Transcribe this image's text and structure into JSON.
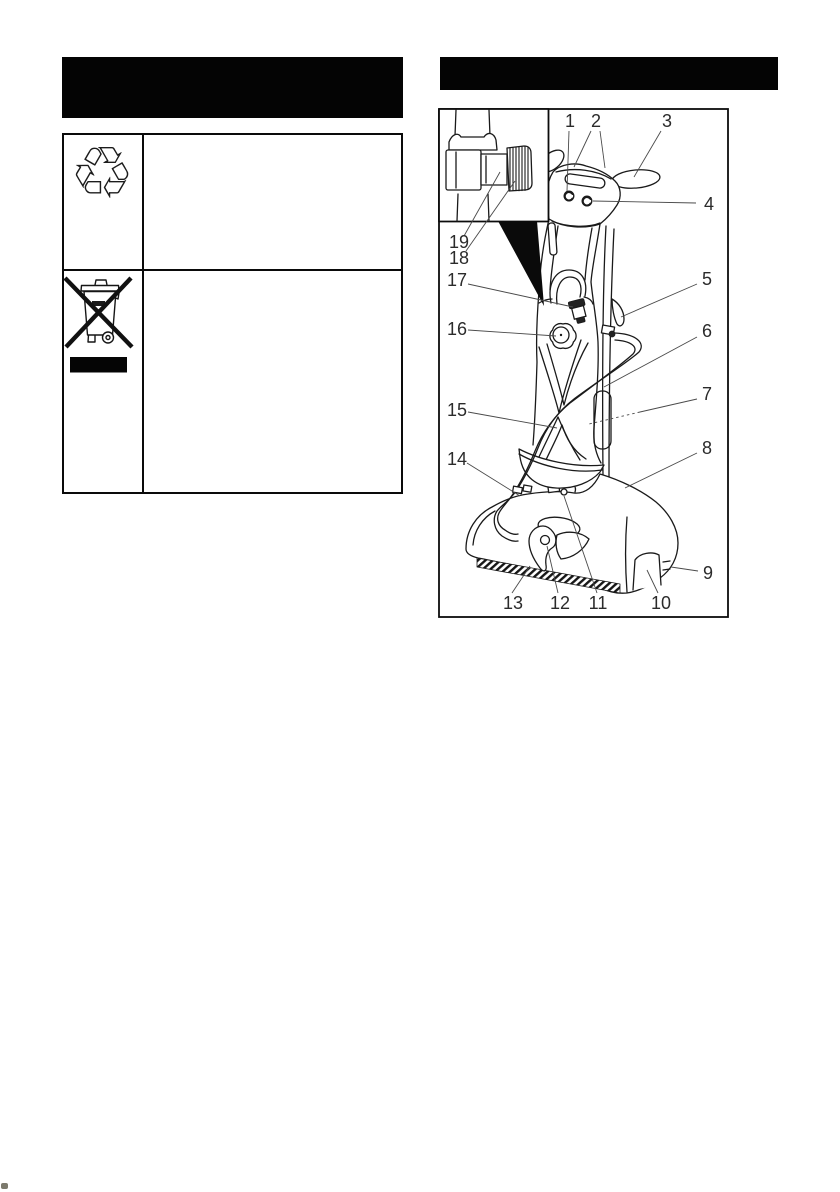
{
  "page": {
    "width": 840,
    "height": 1192,
    "background": "#ffffff",
    "ink": "#1a1a1a",
    "redaction_color": "#040404"
  },
  "left_column": {
    "title_bar": {
      "text": "",
      "style": "solid-black-redacted-two-line"
    },
    "symbol_table": {
      "rows": [
        {
          "icon": "universal-recycling-symbol",
          "glyph": "♲",
          "text": ""
        },
        {
          "icon": "weee-crossed-out-wheeled-bin",
          "glyph": "",
          "text": "",
          "underbar": "solid-black"
        }
      ]
    }
  },
  "right_column": {
    "title_bar": {
      "text": "",
      "style": "solid-black-redacted-one-line"
    },
    "figure": {
      "type": "numbered-parts-diagram",
      "subject": "upright floor scrubber line drawing with detail inset of hose coupling",
      "inset_callouts": [
        "19",
        "18"
      ],
      "callouts": [
        {
          "n": "1",
          "x": 570,
          "y": 121,
          "leaders": [
            [
              569,
              131,
              567,
              191
            ]
          ]
        },
        {
          "n": "2",
          "x": 596,
          "y": 121,
          "leaders": [
            [
              591,
              131,
              574,
              167
            ],
            [
              600,
              131,
              605,
              168
            ]
          ]
        },
        {
          "n": "3",
          "x": 667,
          "y": 121,
          "leaders": [
            [
              661,
              131,
              634,
              177
            ]
          ]
        },
        {
          "n": "4",
          "x": 709,
          "y": 204,
          "leaders": [
            [
              696,
              203,
              593,
              201
            ]
          ]
        },
        {
          "n": "5",
          "x": 707,
          "y": 279,
          "leaders": [
            [
              697,
              284,
              621,
              317
            ]
          ]
        },
        {
          "n": "6",
          "x": 707,
          "y": 331,
          "leaders": [
            [
              697,
              337,
              604,
              387
            ]
          ]
        },
        {
          "n": "7",
          "x": 707,
          "y": 394,
          "leaders": [
            [
              697,
              399,
              640,
              412
            ],
            [
              640,
              412,
              589,
              424,
              "dashed"
            ]
          ]
        },
        {
          "n": "8",
          "x": 707,
          "y": 448,
          "leaders": [
            [
              697,
              453,
              625,
              488
            ]
          ]
        },
        {
          "n": "9",
          "x": 708,
          "y": 573,
          "leaders": [
            [
              698,
              571,
              671,
              567
            ]
          ]
        },
        {
          "n": "10",
          "x": 661,
          "y": 603,
          "leaders": [
            [
              658,
              593,
              647,
              570
            ]
          ]
        },
        {
          "n": "11",
          "x": 598,
          "y": 603,
          "leaders": [
            [
              597,
              593,
              564,
              496
            ]
          ]
        },
        {
          "n": "12",
          "x": 560,
          "y": 603,
          "leaders": [
            [
              558,
              593,
              547,
              546
            ]
          ]
        },
        {
          "n": "13",
          "x": 513,
          "y": 603,
          "leaders": [
            [
              512,
              593,
              530,
              566
            ]
          ]
        },
        {
          "n": "14",
          "x": 457,
          "y": 459,
          "leaders": [
            [
              467,
              463,
              520,
              496
            ]
          ]
        },
        {
          "n": "15",
          "x": 457,
          "y": 410,
          "leaders": [
            [
              468,
              412,
              557,
              428
            ]
          ]
        },
        {
          "n": "16",
          "x": 457,
          "y": 329,
          "leaders": [
            [
              468,
              330,
              556,
              336
            ]
          ]
        },
        {
          "n": "17",
          "x": 457,
          "y": 280,
          "leaders": [
            [
              468,
              284,
              573,
              307
            ]
          ]
        },
        {
          "n": "18",
          "x": 459,
          "y": 258,
          "leaders": [
            [
              466,
              251,
              515,
              181
            ]
          ]
        },
        {
          "n": "19",
          "x": 459,
          "y": 242,
          "leaders": [
            [
              464,
              236,
              500,
              172
            ]
          ]
        }
      ]
    }
  },
  "artifacts": {
    "bottom_left_smudge": true
  }
}
